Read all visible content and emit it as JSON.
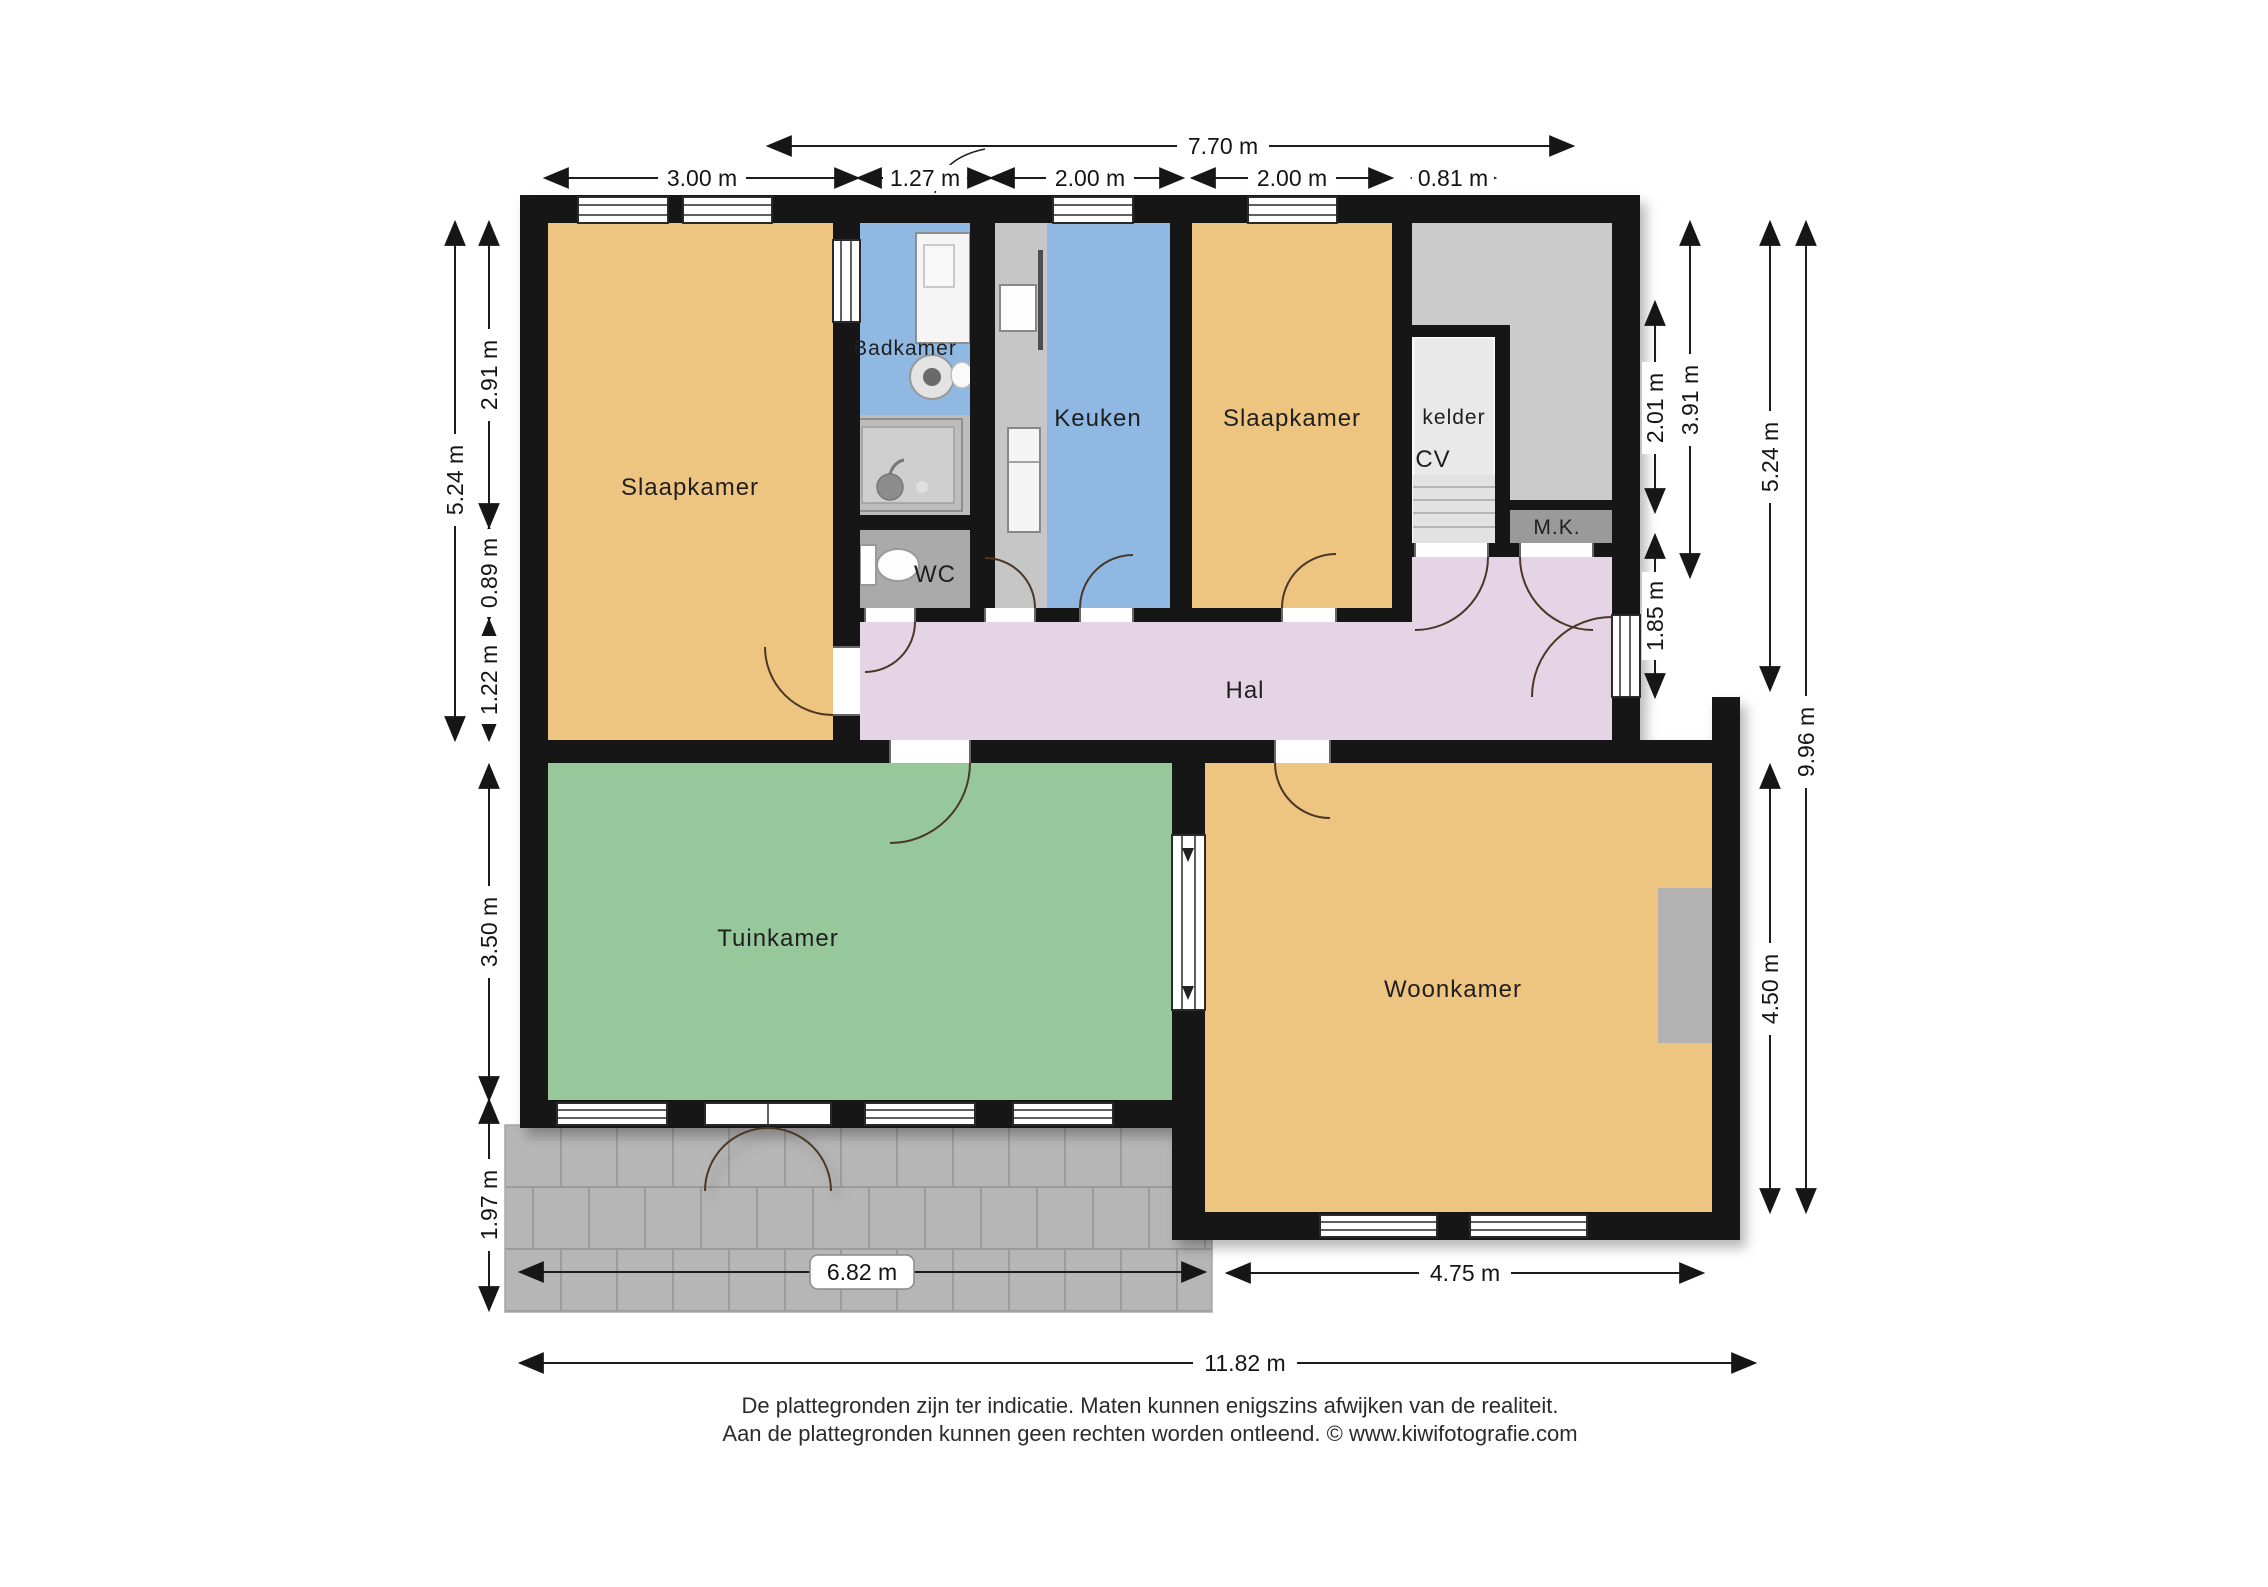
{
  "labels": {
    "slaapkamer_left": "Slaapkamer",
    "badkamer": "Badkamer",
    "keuken": "Keuken",
    "slaapkamer_right": "Slaapkamer",
    "kelder": "kelder",
    "cv": "CV",
    "mk": "M.K.",
    "wc": "WC",
    "hal": "Hal",
    "tuinkamer": "Tuinkamer",
    "woonkamer": "Woonkamer"
  },
  "dimensions": {
    "top_overall": "7.70 m",
    "top_segments": [
      "3.00 m",
      "1.27 m",
      "2.00 m",
      "2.00 m",
      "0.81 m"
    ],
    "left": [
      "5.24 m",
      "2.91 m",
      "0.89 m",
      "1.22 m",
      "3.50 m",
      "1.97 m"
    ],
    "right": [
      "2.01 m",
      "3.91 m",
      "1.85 m",
      "5.24 m",
      "9.96 m",
      "4.50 m"
    ],
    "bottom": [
      "6.82 m",
      "4.75 m",
      "11.82 m"
    ]
  },
  "footer": {
    "line1": "De plattegronden zijn ter indicatie. Maten kunnen enigszins afwijken van de realiteit.",
    "line2": "Aan de plattegronden kunnen geen rechten worden ontleend. © www.kiwifotografie.com"
  },
  "colors": {
    "wall": "#131313",
    "bedroom": "#eec481",
    "bath_blue": "#8fb8e3",
    "green": "#97c89c",
    "hall": "#e5d4e6",
    "gray_room": "#cbcbcb",
    "kelder": "#e9e9e9",
    "mk": "#9a9a9a",
    "wc": "#aaaaaa",
    "shower": "#bdbdbd",
    "counter": "#c6c6c6",
    "terrace": "#b6b6b6",
    "terrace_line": "#9c9c9c",
    "fireplace": "#b2b2b2"
  }
}
